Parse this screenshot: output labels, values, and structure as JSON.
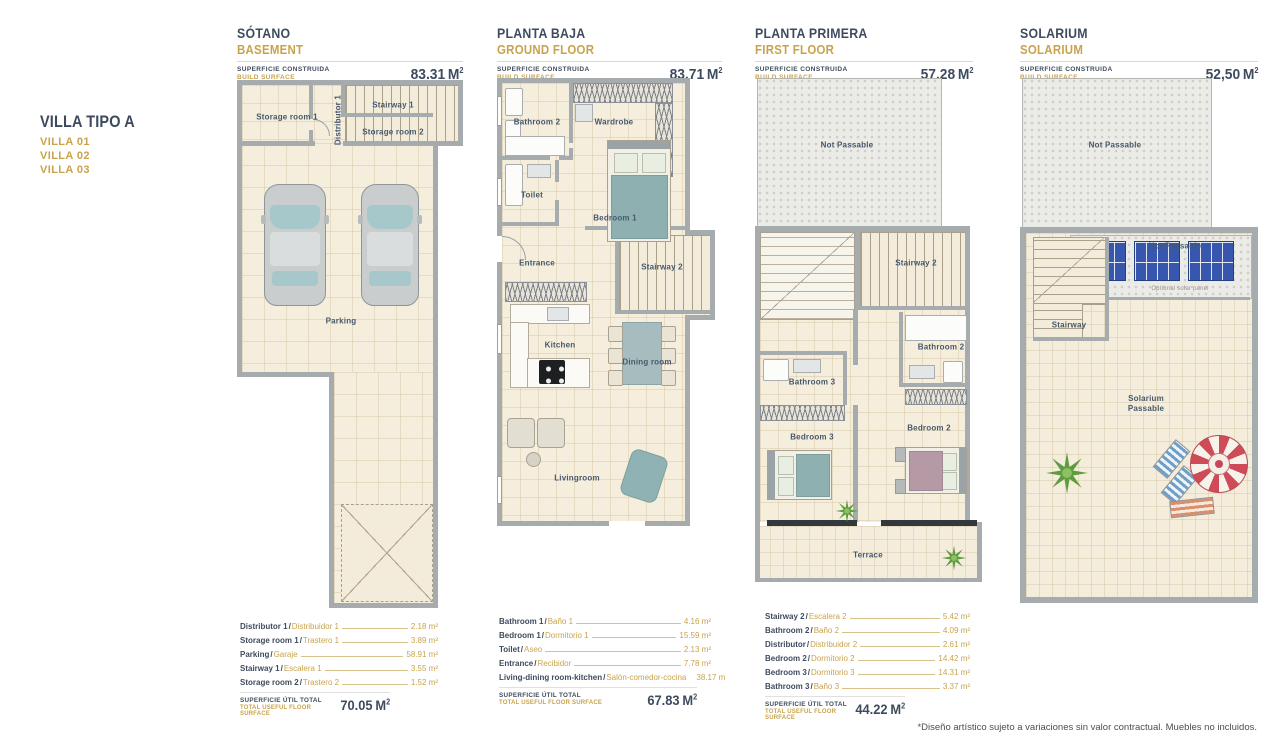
{
  "sep": "/",
  "villa": {
    "title": "VILLA TIPO A",
    "v": [
      "VILLA 01",
      "VILLA 02",
      "VILLA 03"
    ]
  },
  "footer_note": "*Diseño artístico sujeto a variaciones sin valor contractual. Muebles no incluidos.",
  "plans": [
    {
      "title": "SÓTANO",
      "subtitle": "BASEMENT",
      "surface_es": "SUPERFICIE CONSTRUIDA",
      "surface_en": "BUILD SURFACE",
      "area": "83.31",
      "unit": "M",
      "exp": "2",
      "rooms": {
        "storage1": "Storage room 1",
        "distributor1": "Distributor 1",
        "stairway1": "Stairway 1",
        "storage2": "Storage room 2",
        "parking": "Parking"
      },
      "legend": {
        "rows": [
          {
            "en": "Distributor 1",
            "es": "Distribuidor 1",
            "value": "2.18 m²"
          },
          {
            "en": "Storage room 1",
            "es": "Trastero 1",
            "value": "3.89 m²"
          },
          {
            "en": "Parking",
            "es": "Garaje",
            "value": "58.91 m²"
          },
          {
            "en": "Stairway 1",
            "es": "Escalera 1",
            "value": "3.55 m²"
          },
          {
            "en": "Storage room 2",
            "es": "Trastero 2",
            "value": "1.52 m²"
          }
        ],
        "total_es": "SUPERFICIE ÚTIL TOTAL",
        "total_en": "TOTAL USEFUL FLOOR SURFACE",
        "total": "70.05",
        "unit": "M",
        "exp": "2"
      }
    },
    {
      "title": "PLANTA BAJA",
      "subtitle": "GROUND FLOOR",
      "surface_es": "SUPERFICIE CONSTRUIDA",
      "surface_en": "BUILD SURFACE",
      "area": "83.71",
      "unit": "M",
      "exp": "2",
      "rooms": {
        "bathroom2": "Bathroom 2",
        "wardrobe": "Wardrobe",
        "toilet": "Toilet",
        "bedroom1": "Bedroom 1",
        "entrance": "Entrance",
        "stairway2": "Stairway 2",
        "kitchen": "Kitchen",
        "dining": "Dining room",
        "living": "Livingroom"
      },
      "legend": {
        "rows": [
          {
            "en": "Bathroom 1",
            "es": "Baño 1",
            "value": "4.16 m²"
          },
          {
            "en": "Bedroom 1",
            "es": "Dormitorio 1",
            "value": "15.59 m²"
          },
          {
            "en": "Toilet",
            "es": "Aseo",
            "value": "2.13 m²"
          },
          {
            "en": "Entrance",
            "es": "Recibidor",
            "value": "7.78 m²"
          },
          {
            "en": "Living-dining room-kitchen",
            "es": "Salón-comedor-cocina",
            "value": "38.17 m"
          }
        ],
        "total_es": "SUPERFICIE ÚTIL TOTAL",
        "total_en": "TOTAL USEFUL FLOOR SURFACE",
        "total": "67.83",
        "unit": "M",
        "exp": "2"
      }
    },
    {
      "title": "PLANTA PRIMERA",
      "subtitle": "FIRST FLOOR",
      "surface_es": "SUPERFICIE CONSTRUIDA",
      "surface_en": "BUILD SURFACE",
      "area": "57.28",
      "unit": "M",
      "exp": "2",
      "rooms": {
        "notpass": "Not Passable",
        "stairway2": "Stairway 2",
        "bathroom2": "Bathroom 2",
        "bathroom3": "Bathroom 3",
        "bedroom3": "Bedroom 3",
        "bedroom2": "Bedroom 2",
        "terrace": "Terrace"
      },
      "legend": {
        "rows": [
          {
            "en": "Stairway 2",
            "es": "Escalera 2",
            "value": "5.42 m²"
          },
          {
            "en": "Bathroom 2",
            "es": "Baño 2",
            "value": "4.09 m²"
          },
          {
            "en": "Distributor",
            "es": "Distribuidor 2",
            "value": "2.61 m²"
          },
          {
            "en": "Bedroom 2",
            "es": "Dormitorio 2",
            "value": "14.42 m²"
          },
          {
            "en": "Bedroom 3",
            "es": "Dormitorio 3",
            "value": "14.31 m²"
          },
          {
            "en": "Bathroom 3",
            "es": "Baño 3",
            "value": "3.37 m²"
          }
        ],
        "total_es": "SUPERFICIE ÚTIL TOTAL",
        "total_en": "TOTAL USEFUL FLOOR SURFACE",
        "total": "44.22",
        "unit": "M",
        "exp": "2"
      }
    },
    {
      "title": "SOLARIUM",
      "subtitle": "SOLARIUM",
      "surface_es": "SUPERFICIE CONSTRUIDA",
      "surface_en": "BUILD SURFACE",
      "area": "52,50",
      "unit": "M",
      "exp": "2",
      "rooms": {
        "notpass_top": "Not Passable",
        "notpass": "Not Passable",
        "solar_caption": "Optional solar panel",
        "stairway": "Stairway",
        "solarium": "Solarium\nPassable"
      }
    }
  ]
}
